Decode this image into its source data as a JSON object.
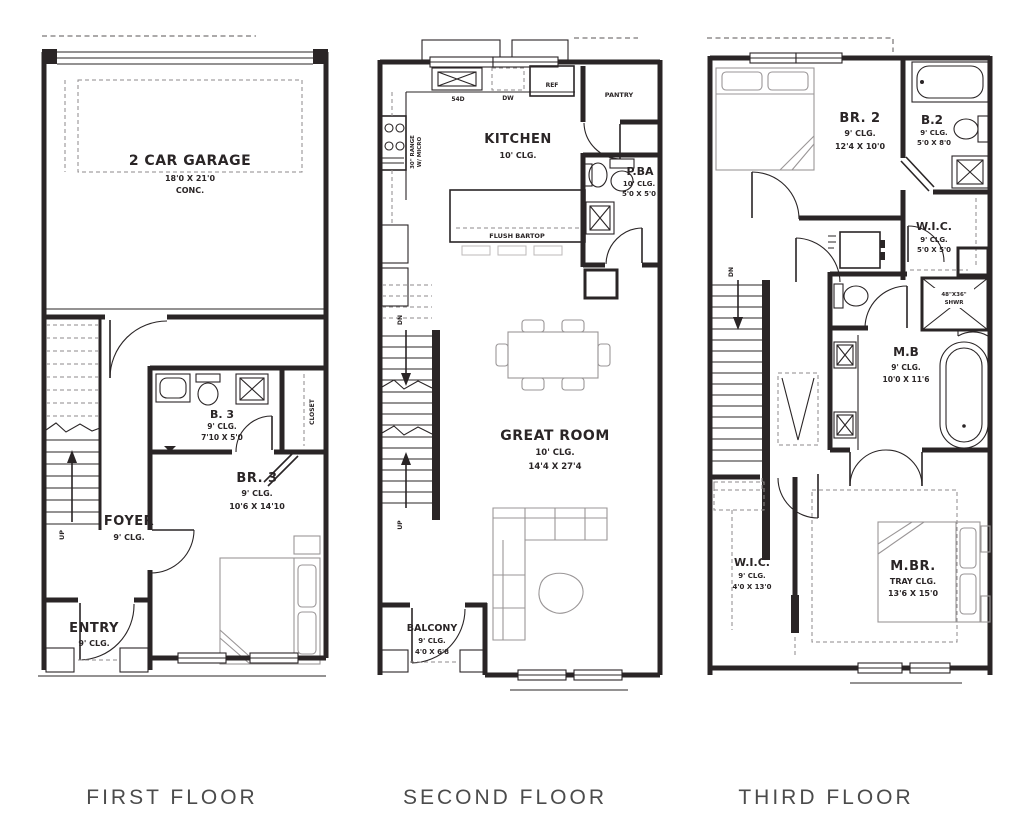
{
  "labels": {
    "first": "FIRST FLOOR",
    "second": "SECOND FLOOR",
    "third": "THIRD FLOOR"
  },
  "floor1": {
    "garage": {
      "name": "2 CAR GARAGE",
      "size": "18'0 X 21'0",
      "note": "CONC."
    },
    "bath3": {
      "name": "B. 3",
      "clg": "9' CLG.",
      "size": "7'10 X 5'0"
    },
    "closet": {
      "name": "CLOSET"
    },
    "br3": {
      "name": "BR. 3",
      "clg": "9' CLG.",
      "size": "10'6 X 14'10"
    },
    "foyer": {
      "name": "FOYER",
      "clg": "9' CLG."
    },
    "entry": {
      "name": "ENTRY",
      "clg": "9' CLG."
    },
    "stairs": {
      "up": "UP"
    }
  },
  "floor2": {
    "kitchen": {
      "name": "KITCHEN",
      "clg": "10' CLG."
    },
    "sink_label": "54D",
    "dw": "DW",
    "ref": "REF",
    "pantry": "PANTRY",
    "range_l1": "30\" RANGE",
    "range_l2": "W/ MICRO",
    "pba": {
      "name": "P.BA",
      "clg": "10' CLG.",
      "size": "5'0 X 5'0"
    },
    "bartop": "FLUSH BARTOP",
    "great": {
      "name": "GREAT ROOM",
      "clg": "10' CLG.",
      "size": "14'4 X 27'4"
    },
    "balcony": {
      "name": "BALCONY",
      "clg": "9' CLG.",
      "size": "4'0 X 6'8"
    },
    "stairs": {
      "dn": "DN",
      "up": "UP"
    }
  },
  "floor3": {
    "br2": {
      "name": "BR. 2",
      "clg": "9' CLG.",
      "size": "12'4 X 10'0"
    },
    "b2": {
      "name": "B.2",
      "clg": "9' CLG.",
      "size": "5'0 X 8'0"
    },
    "wic_upper": {
      "name": "W.I.C.",
      "clg": "9' CLG.",
      "size": "5'0 X 5'0"
    },
    "shower": {
      "l1": "48\"X36\"",
      "l2": "SHWR"
    },
    "mb": {
      "name": "M.B",
      "clg": "9' CLG.",
      "size": "10'0 X 11'6"
    },
    "wic_lower": {
      "name": "W.I.C.",
      "clg": "9' CLG.",
      "size": "4'0 X 13'0"
    },
    "mbr": {
      "name": "M.BR.",
      "clg": "TRAY CLG.",
      "size": "13'6 X 15'0"
    },
    "stairs": {
      "dn": "DN"
    }
  }
}
